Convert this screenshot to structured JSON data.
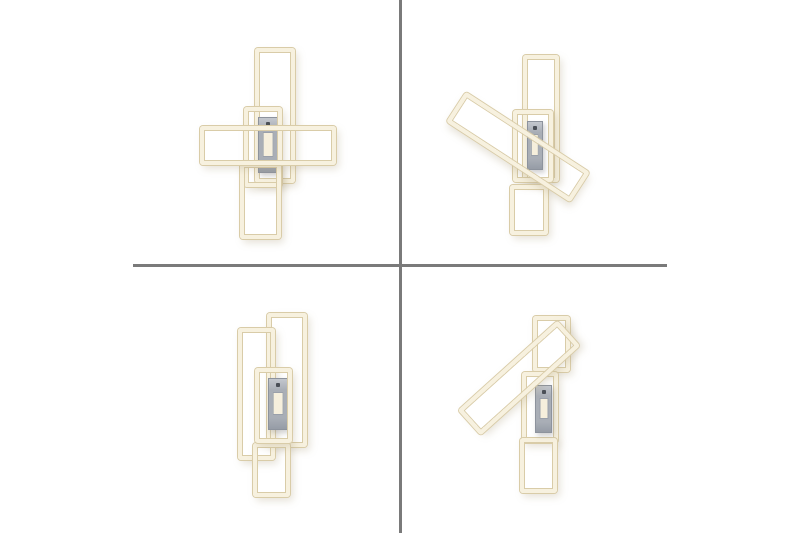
{
  "canvas": {
    "width": 800,
    "height": 533,
    "background": "#ffffff"
  },
  "palette": {
    "frame_fill": "#f7f1df",
    "frame_edge": "#d9cca8",
    "frame_shadow": "rgba(168,156,120,0.28)",
    "canopy_fill": "#a9aeb6",
    "canopy_hi": "#c3c7ce",
    "canopy_lo": "#969ca6",
    "canopy_edge": "#8d939d",
    "panel_fill": "#f6efdc",
    "panel_edge": "#9aa0aa",
    "sensor_dot": "#4a4f57",
    "divider": "#7a7a7a"
  },
  "dividers": [
    {
      "name": "grid-divider-vertical",
      "x": 399,
      "y": 0,
      "w": 3,
      "h": 533
    },
    {
      "name": "grid-divider-horizontal",
      "x": 133,
      "y": 264,
      "w": 534,
      "h": 3
    }
  ],
  "views": [
    {
      "quadrant": "top-left",
      "elements": [
        {
          "type": "frame",
          "part": "top-frame",
          "x": 255,
          "y": 48,
          "w": 40,
          "h": 135,
          "rot": 0
        },
        {
          "type": "canopy",
          "part": "canopy",
          "x": 258,
          "y": 117,
          "w": 20,
          "h": 56
        },
        {
          "type": "frame",
          "part": "middle-frame",
          "x": 244,
          "y": 107,
          "w": 38,
          "h": 80,
          "rot": 0
        },
        {
          "type": "frame",
          "part": "bottom-frame",
          "x": 240,
          "y": 163,
          "w": 41,
          "h": 76,
          "rot": 0
        },
        {
          "type": "frame",
          "part": "cross-frame",
          "x": 200,
          "y": 126,
          "w": 136,
          "h": 39,
          "rot": 0
        }
      ]
    },
    {
      "quadrant": "top-right",
      "elements": [
        {
          "type": "frame",
          "part": "top-frame",
          "x": 523,
          "y": 55,
          "w": 36,
          "h": 127,
          "rot": 0
        },
        {
          "type": "frame",
          "part": "middle-frame",
          "x": 513,
          "y": 110,
          "w": 40,
          "h": 72,
          "rot": 0
        },
        {
          "type": "frame",
          "part": "bottom-frame",
          "x": 510,
          "y": 185,
          "w": 38,
          "h": 50,
          "rot": 0
        },
        {
          "type": "canopy",
          "part": "canopy",
          "x": 527,
          "y": 121,
          "w": 16,
          "h": 49
        },
        {
          "type": "frame",
          "part": "diagonal-frame",
          "x": 444,
          "y": 129,
          "w": 148,
          "h": 36,
          "rot": 33
        }
      ]
    },
    {
      "quadrant": "bottom-left",
      "elements": [
        {
          "type": "frame",
          "part": "right-frame",
          "x": 267,
          "y": 313,
          "w": 40,
          "h": 134,
          "rot": 0
        },
        {
          "type": "frame",
          "part": "left-frame",
          "x": 238,
          "y": 328,
          "w": 37,
          "h": 132,
          "rot": 0
        },
        {
          "type": "frame",
          "part": "bottom-frame",
          "x": 253,
          "y": 443,
          "w": 37,
          "h": 54,
          "rot": 0
        },
        {
          "type": "canopy",
          "part": "canopy",
          "x": 268,
          "y": 378,
          "w": 20,
          "h": 52
        },
        {
          "type": "frame",
          "part": "middle-frame",
          "x": 255,
          "y": 368,
          "w": 37,
          "h": 75,
          "rot": 0
        }
      ]
    },
    {
      "quadrant": "bottom-right",
      "elements": [
        {
          "type": "frame",
          "part": "top-frame",
          "x": 533,
          "y": 316,
          "w": 37,
          "h": 56,
          "rot": 0
        },
        {
          "type": "frame",
          "part": "middle-frame",
          "x": 522,
          "y": 372,
          "w": 36,
          "h": 71,
          "rot": 0
        },
        {
          "type": "frame",
          "part": "bottom-frame",
          "x": 520,
          "y": 438,
          "w": 37,
          "h": 55,
          "rot": 0
        },
        {
          "type": "canopy",
          "part": "canopy",
          "x": 535,
          "y": 385,
          "w": 17,
          "h": 48
        },
        {
          "type": "frame",
          "part": "diagonal-frame",
          "x": 452,
          "y": 361,
          "w": 134,
          "h": 34,
          "rot": -42
        }
      ]
    }
  ]
}
